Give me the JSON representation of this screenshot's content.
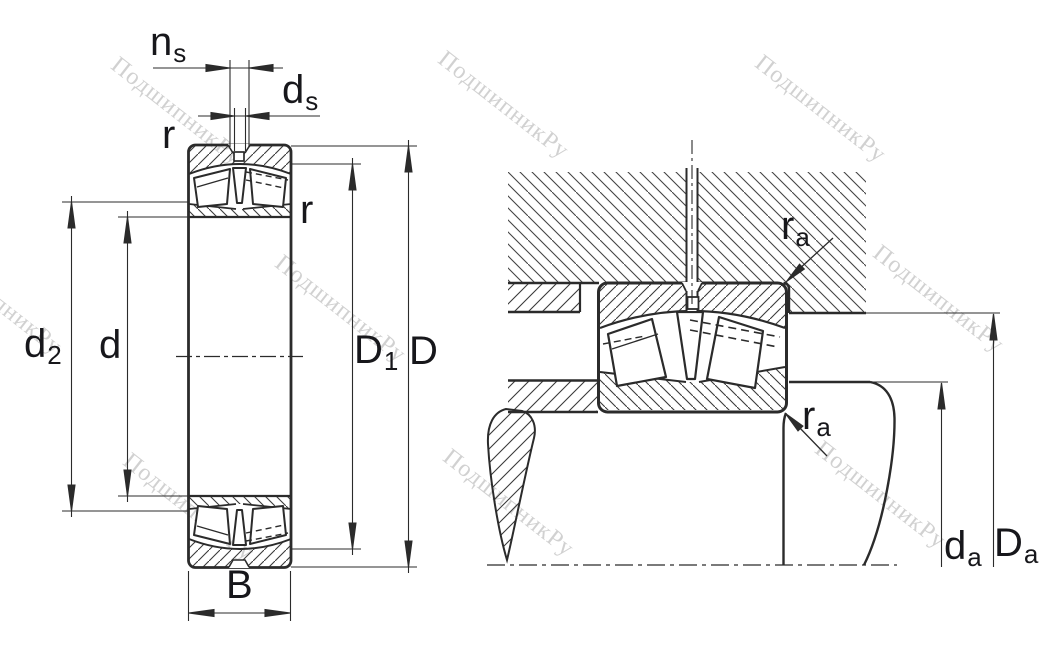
{
  "watermark": {
    "text": "ПодшипникРу"
  },
  "colors": {
    "line": "#2b2b2b",
    "label": "#17171b",
    "watermark": "#c6c6c6"
  },
  "labels": {
    "ns": {
      "base": "n",
      "sub": "s"
    },
    "ds": {
      "base": "d",
      "sub": "s"
    },
    "r_top_left": "r",
    "r_right": "r",
    "d2": {
      "base": "d",
      "sub": "2"
    },
    "d": "d",
    "D1": {
      "base": "D",
      "sub": "1"
    },
    "D": "D",
    "B": "B",
    "ra_top": {
      "base": "r",
      "sub": "a"
    },
    "ra_bottom": {
      "base": "r",
      "sub": "a"
    },
    "da": {
      "base": "d",
      "sub": "a"
    },
    "Da": {
      "base": "D",
      "sub": "a"
    }
  }
}
